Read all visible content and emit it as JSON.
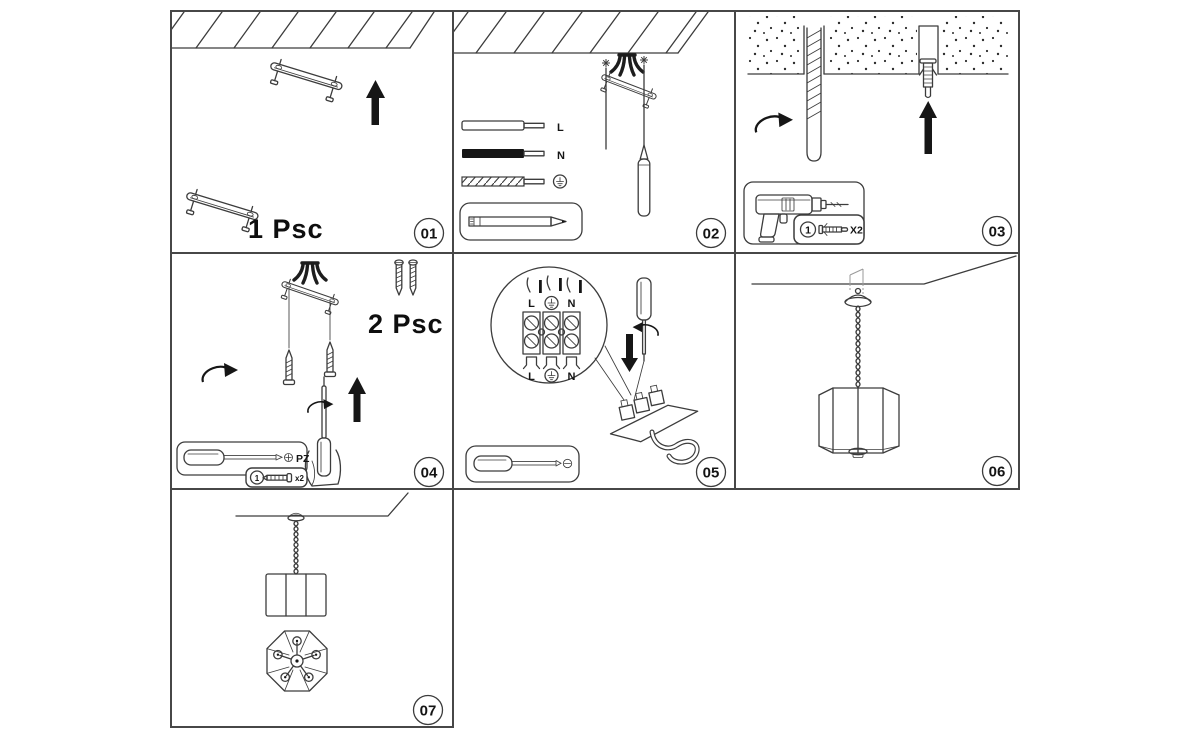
{
  "colors": {
    "background": "#ffffff",
    "ink": "#3c3c3c",
    "solid_black": "#161616"
  },
  "steps": {
    "s01": {
      "badge": "01",
      "quantity": "1 Psc"
    },
    "s02": {
      "badge": "02",
      "wire_live": "L",
      "wire_neutral": "N"
    },
    "s03": {
      "badge": "03",
      "kit_item_number": "1",
      "kit_quantity": "X2"
    },
    "s04": {
      "badge": "04",
      "quantity": "2 Psc",
      "screwdriver_bit": "PZ",
      "kit_item_number": "1",
      "kit_quantity": "x2"
    },
    "s05": {
      "badge": "05",
      "top_live": "L",
      "top_neutral": "N",
      "bottom_live": "L",
      "bottom_neutral": "N"
    },
    "s06": {
      "badge": "06"
    },
    "s07": {
      "badge": "07"
    }
  }
}
